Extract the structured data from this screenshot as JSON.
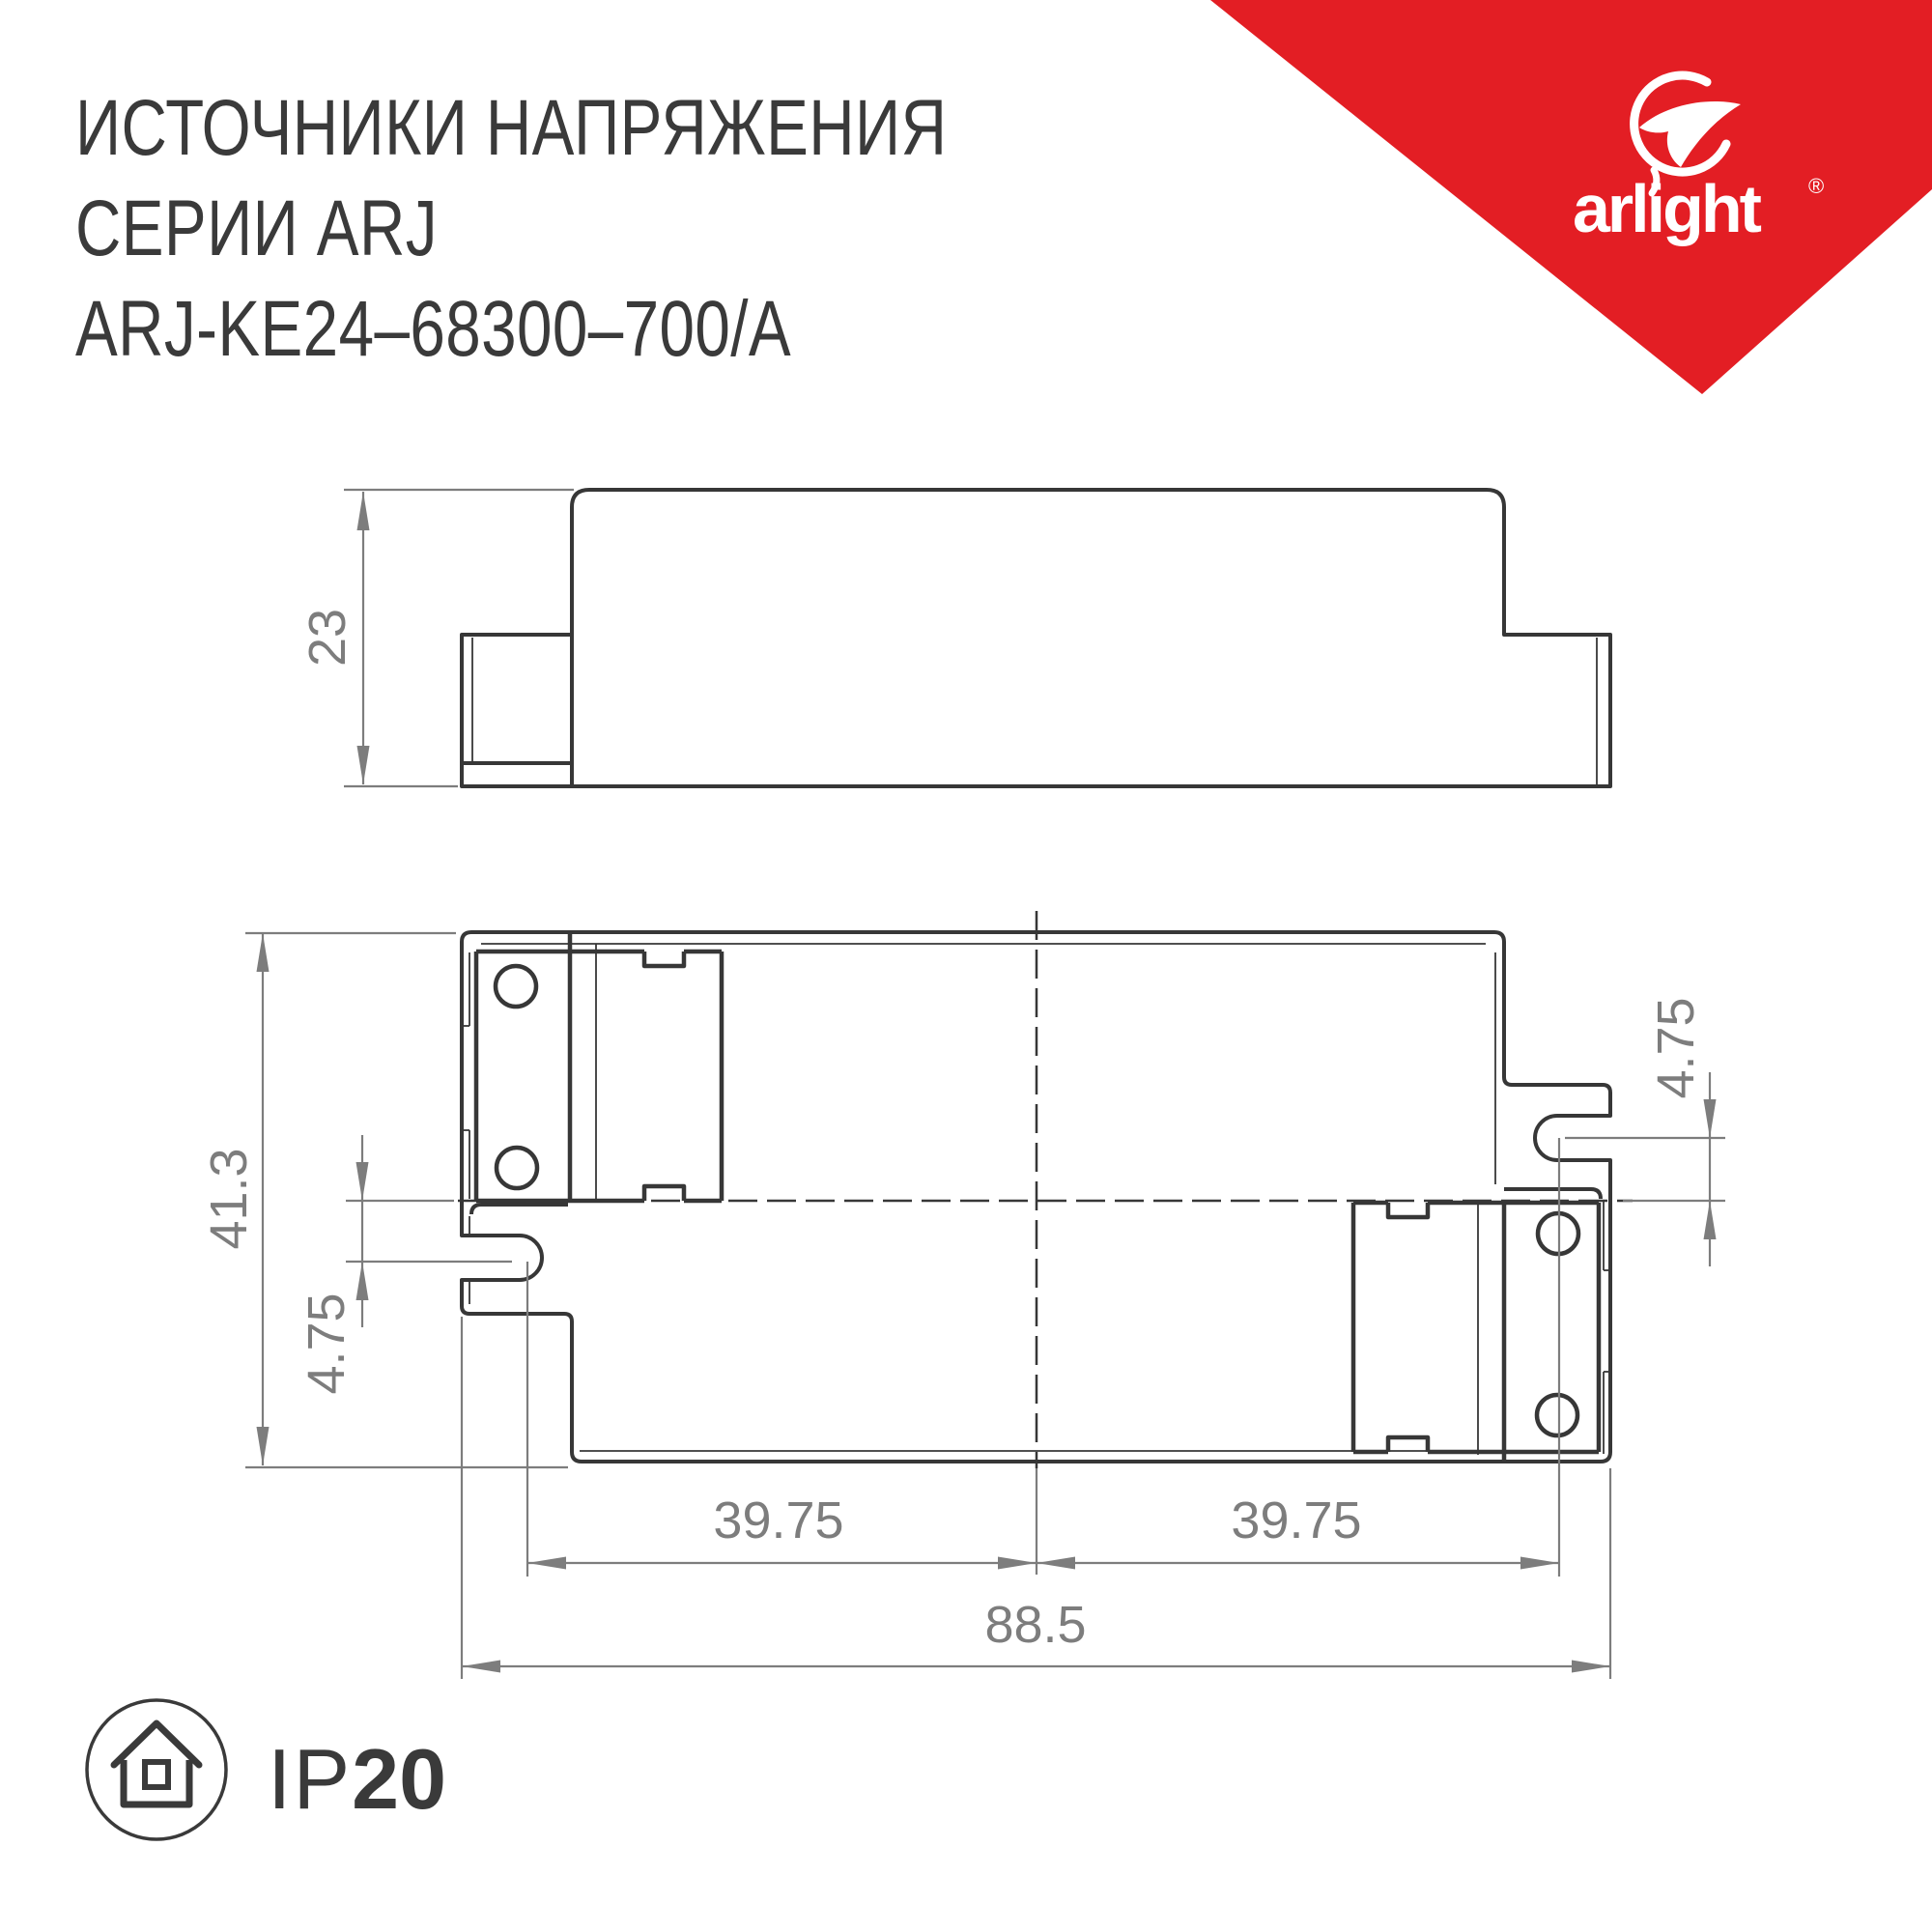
{
  "title": {
    "line1": "ИСТОЧНИКИ НАПРЯЖЕНИЯ",
    "line2": "СЕРИИ ARJ",
    "line3": "ARJ-KE24–68300–700/A"
  },
  "brand": {
    "logo_text": "arlight",
    "registered_mark": "®",
    "logo_icon": "arlight-balloon-swoosh-icon",
    "banner_color": "#E31E24",
    "logo_color": "#ffffff"
  },
  "drawing": {
    "line_color": "#373737",
    "dimension_color": "#7d7d7d",
    "side_view": {
      "height_mm": "23"
    },
    "top_view": {
      "depth_mm": "41.3",
      "slot_offset_left_mm": "4.75",
      "slot_offset_right_mm": "4.75",
      "slot_span_left_mm": "39.75",
      "slot_span_right_mm": "39.75",
      "total_length_mm": "88.5"
    }
  },
  "footer": {
    "ip_rating_prefix": "IP",
    "ip_rating_value": "20",
    "ip_icon": "house-in-circle-icon"
  }
}
